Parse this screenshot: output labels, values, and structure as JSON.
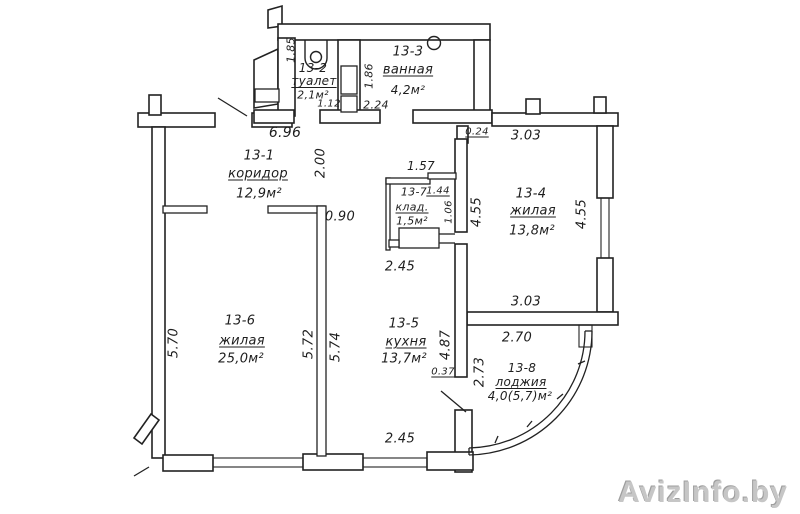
{
  "title": "Apartment floor plan",
  "watermark": "AvizInfo.by",
  "rooms": {
    "r1": {
      "id": "13-1",
      "name": "коридор",
      "area": "12,9м²"
    },
    "r2": {
      "id": "13-2",
      "name": "туалет",
      "area": "2,1м²"
    },
    "r3": {
      "id": "13-3",
      "name": "ванная",
      "area": "4,2м²"
    },
    "r4": {
      "id": "13-4",
      "name": "жилая",
      "area": "13,8м²"
    },
    "r5": {
      "id": "13-5",
      "name": "кухня",
      "area": "13,7м²"
    },
    "r6": {
      "id": "13-6",
      "name": "жилая",
      "area": "25,0м²"
    },
    "r7": {
      "id": "13-7",
      "name": "клад.",
      "area": "1,5м²"
    },
    "r8": {
      "id": "13-8",
      "name": "лоджия",
      "area": "4,0(5,7)м²"
    }
  },
  "dims": {
    "toilet_h": "1.85",
    "toilet_door": "1.12",
    "bath_h": "1.86",
    "bath_w": "2.24",
    "corridor_w": "6.96",
    "corridor_h": "2.00",
    "corridor_nook": "0.90",
    "top_right_small": "0.24",
    "top_right_w": "3.03",
    "storage_top": "1.57",
    "storage_w": "1.44",
    "storage_h": "1.06",
    "room4_left_h": "4.55",
    "room4_right_h": "4.55",
    "room4_bottom_w": "3.03",
    "kitchen_top_w": "2.45",
    "kitchen_h": "4.87",
    "kitchen_pass": "0.37",
    "kitchen_bottom_w": "2.45",
    "room6_left_h": "5.70",
    "room6_right_h": "5.72",
    "kitchen_left_h": "5.74",
    "loggia_top_w": "2.70",
    "loggia_left_h": "2.73"
  },
  "colors": {
    "line": "#222222",
    "paper": "#ffffff",
    "watermark": "#c6c6c6"
  }
}
